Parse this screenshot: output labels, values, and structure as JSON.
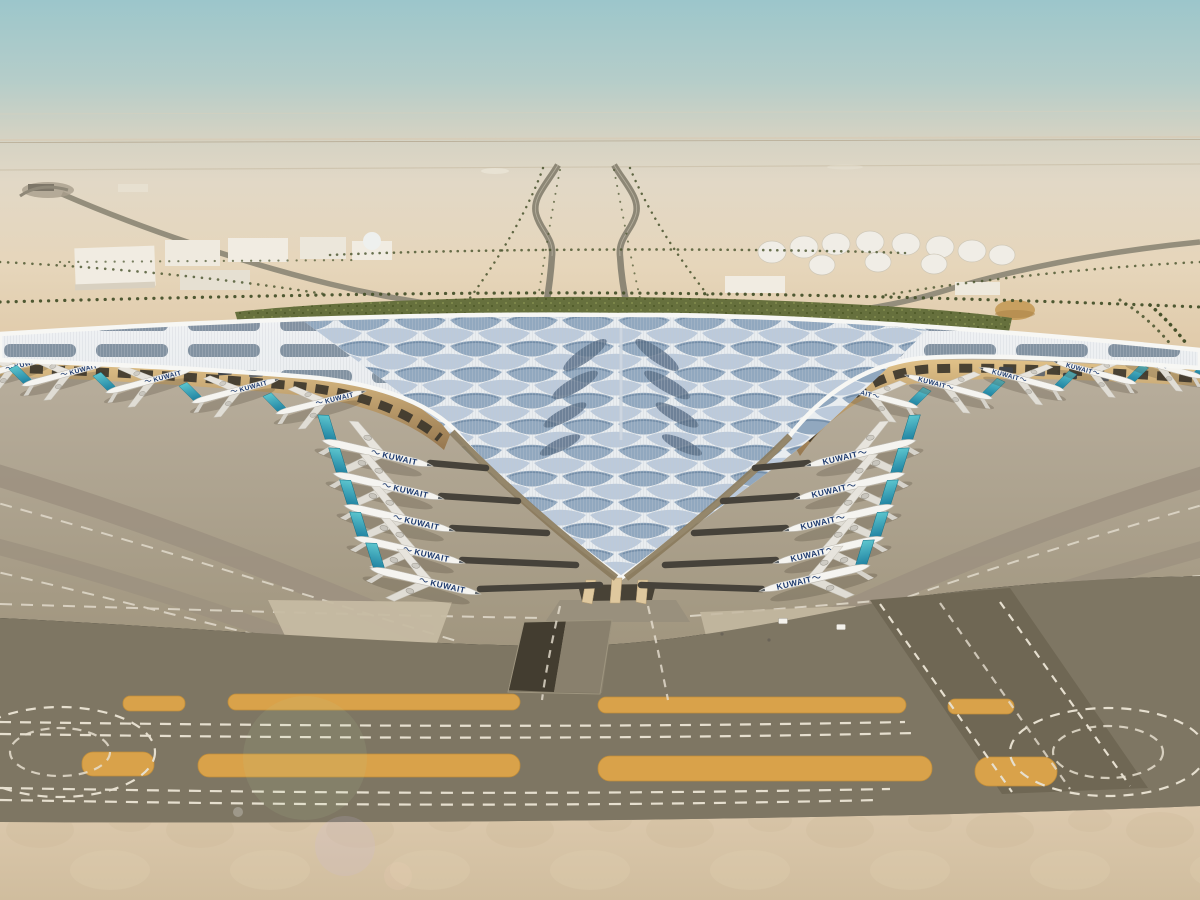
{
  "scene": {
    "airline_wordmark": "KUWAIT",
    "colors": {
      "sky_top": "#9cc6cb",
      "sky_haze": "#d3d2c3",
      "desert": "#e3d2b6",
      "desert_warm": "#dfc9a8",
      "green_band": "#66703d",
      "palm_row": "#46512b",
      "road_grey": "#8d8776",
      "building_white": "#f1ece2",
      "apron": "#aea38f",
      "apron_band": "#9c9180",
      "taxiway_dark": "#7e7663",
      "taxiway_diagonal": "#6f6754",
      "marking_amber": "#d9a24a",
      "marking_white": "#e6dfcf",
      "foreground_sand": "#d8c6a9",
      "roof_silver": "#e9edf0",
      "roof_feather_blue": "#8aa2bb",
      "roof_feather_light": "#b4c5d7",
      "roof_solar": "#687a8d",
      "roof_fascia": "#f7f7f4",
      "soffit_gold": "#caa36f",
      "soffit_dark": "#3d372c",
      "fuselage_white": "#f5f4f0",
      "tail_teal": "#36a9bc",
      "tail_teal_deep": "#1b7d9e",
      "wordmark_navy": "#1d3a6e"
    },
    "planes": {
      "groups": [
        {
          "name": "left-wing-gates",
          "facing": "right",
          "layer": "planes-under",
          "items": [
            [
              -35,
              380,
              -15,
              0.8
            ],
            [
              20,
              386,
              -15,
              0.8
            ],
            [
              104,
              393,
              -15,
              0.8
            ],
            [
              190,
              403,
              -15,
              0.8
            ],
            [
              274,
              414,
              -14,
              0.82
            ]
          ]
        },
        {
          "name": "right-wing-gates",
          "facing": "left",
          "layer": "planes-under",
          "items": [
            [
              920,
              408,
              15,
              0.8
            ],
            [
              994,
              399,
              15,
              0.8
            ],
            [
              1066,
              391,
              15,
              0.78
            ],
            [
              1138,
              384,
              15,
              0.76
            ],
            [
              1205,
              378,
              15,
              0.75
            ]
          ]
        },
        {
          "name": "left-pier-gates",
          "facing": "right",
          "layer": "planes-over",
          "items": [
            [
              320,
              440,
              13,
              1
            ],
            [
              331,
              473,
              13,
              1
            ],
            [
              342,
              505,
              13,
              1
            ],
            [
              352,
              537,
              13,
              1
            ],
            [
              368,
              568,
              13,
              1
            ]
          ]
        },
        {
          "name": "right-pier-gates",
          "facing": "left",
          "layer": "planes-over",
          "items": [
            [
              918,
              440,
              -13,
              1
            ],
            [
              907,
              473,
              -13,
              1
            ],
            [
              896,
              505,
              -13,
              1
            ],
            [
              886,
              537,
              -13,
              1
            ],
            [
              872,
              565,
              -13,
              1
            ]
          ]
        }
      ]
    },
    "jet_bridges": [
      [
        486,
        468,
        430,
        463
      ],
      [
        518,
        501,
        441,
        496
      ],
      [
        547,
        533,
        452,
        528
      ],
      [
        576,
        565,
        462,
        560
      ],
      [
        600,
        585,
        480,
        589
      ],
      [
        755,
        468,
        808,
        463
      ],
      [
        723,
        501,
        797,
        496
      ],
      [
        694,
        533,
        786,
        528
      ],
      [
        665,
        565,
        776,
        560
      ],
      [
        641,
        585,
        762,
        589
      ]
    ],
    "curbside_vehicles": [
      [
        70,
        362,
        -4
      ],
      [
        225,
        372,
        -4
      ],
      [
        256,
        374,
        -4
      ],
      [
        1006,
        370,
        3
      ],
      [
        1038,
        373,
        3
      ],
      [
        1070,
        376,
        3
      ],
      [
        1102,
        378,
        3
      ]
    ],
    "service_vehicles": [
      [
        783,
        621
      ],
      [
        841,
        627
      ]
    ],
    "bollards": [
      [
        769,
        640
      ],
      [
        722,
        634
      ]
    ]
  }
}
